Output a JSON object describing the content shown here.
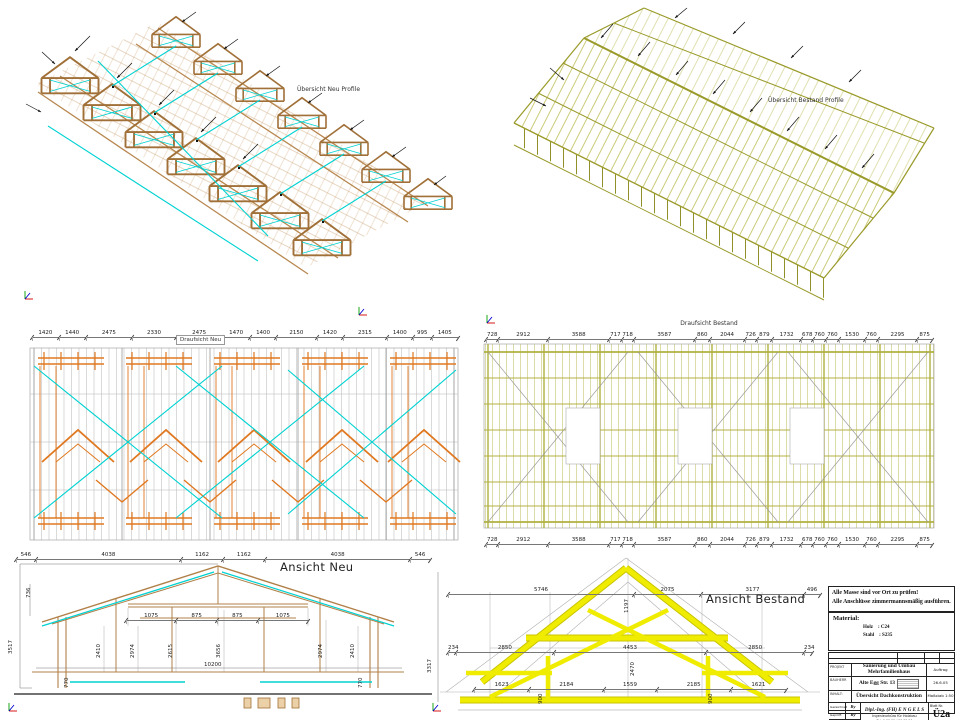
{
  "views": {
    "uebersicht_neu": {
      "title": "Übersicht Neu Profile"
    },
    "uebersicht_bestand": {
      "title": "Übersicht Bestand Profile"
    },
    "draufsicht_neu": {
      "title": "Draufsicht Neu",
      "top_dims": [
        1420,
        1440,
        2475,
        2330,
        2475,
        1470,
        1400,
        2150,
        1420,
        2315,
        1400,
        995,
        1405
      ]
    },
    "draufsicht_bestand": {
      "title": "Draufsicht Bestand",
      "top_dims": [
        728,
        2912,
        3588,
        717,
        718,
        3587,
        860,
        2044,
        726,
        879,
        1732,
        678,
        760,
        760,
        1530,
        760,
        2295,
        875
      ],
      "bottom_dims": [
        728,
        2912,
        3588,
        717,
        718,
        3587,
        860,
        2044,
        726,
        879,
        1732,
        678,
        760,
        760,
        1530,
        760,
        2295,
        875
      ]
    },
    "ansicht_neu": {
      "title": "Ansicht Neu",
      "top_dims": [
        546,
        4038,
        1162,
        1162,
        4038,
        546
      ],
      "mid_dims": [
        1075,
        875,
        875,
        1075
      ],
      "vlabels": [
        "736",
        "3517",
        "2410",
        "2974",
        "2615",
        "3656",
        "2974",
        "2410",
        "770",
        "770"
      ],
      "bottom_dim": "10200"
    },
    "ansicht_bestand": {
      "title": "Ansicht Bestand",
      "top_dims": [
        5746,
        2075,
        3177,
        496
      ],
      "mid_dims": [
        234,
        2850,
        4453,
        2850,
        234
      ],
      "lower_dims": [
        1623,
        2184,
        1559,
        2185,
        1621
      ],
      "vlabels": [
        "3317",
        "1197",
        "2470",
        "900",
        "900"
      ]
    }
  },
  "notes": {
    "line1": "Alle Masse sind vor Ort zu prüfen!",
    "line2": "Alle Anschlüsse zimmermannsmäßig ausführen."
  },
  "material": {
    "label": "Material:",
    "rows": [
      {
        "name": "Holz",
        "value": ": C24"
      },
      {
        "name": "Stahl",
        "value": ": S235"
      }
    ]
  },
  "title_block": {
    "project_label": "PROJEKT",
    "project": "Sanierung und Umbau Mehrfamilienhaus",
    "order_label": "Auftrag",
    "client_label": "BAUHERR",
    "client": "Alte Egg Str. 13",
    "date": "26.6.05",
    "content_label": "INHALT:",
    "content": "Übersicht Dachkonstruktion",
    "scale_label": "Maßstab",
    "scale": "1:50",
    "sign_rows": [
      {
        "label": "Gezeichnet",
        "value": "Ry"
      },
      {
        "label": "Geprüft",
        "value": "Ry"
      },
      {
        "label": "Datum",
        "value": ""
      }
    ],
    "firm_line1": "Dipl.-Ing. (FH)  E N G E L S",
    "firm_line2": "Ingenieurbüro für Holzbau",
    "firm_line3": "Tel. 0 00 00 / 00 00 00",
    "sheet_label": "Blatt Nr.",
    "sheet_no": "Ü2a"
  },
  "colors": {
    "timber_tan": "#b88850",
    "timber_outline": "#a07038",
    "cyan_bracing": "#00d2d2",
    "orange_beam": "#e07820",
    "olive_existing": "#a8a832",
    "yellow_highlight": "#ece800",
    "construction_gray": "#9a9a9a"
  },
  "icons": {
    "ucs": "ucs-axis-icon",
    "arrow": "leader-arrow-icon"
  }
}
